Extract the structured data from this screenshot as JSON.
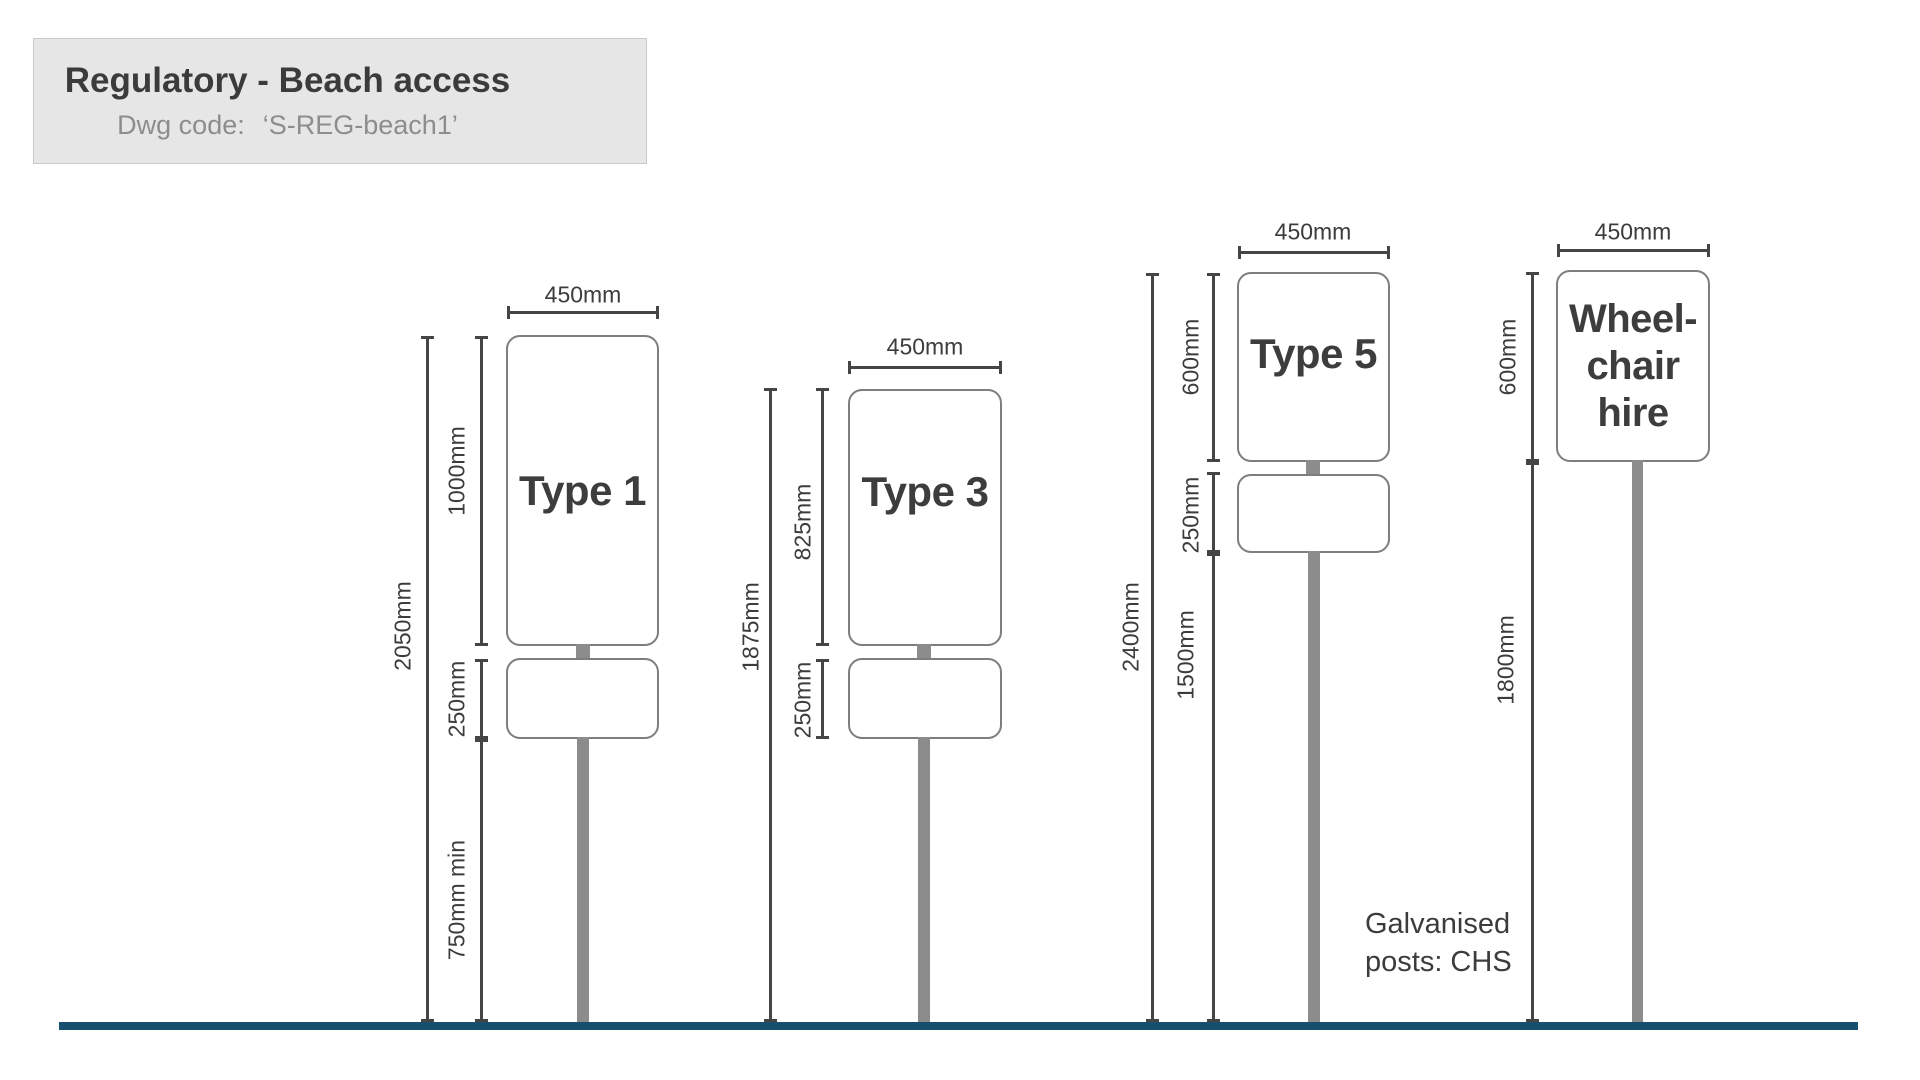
{
  "title_block": {
    "title": "Regulatory - Beach access",
    "dwg_label": "Dwg code:",
    "dwg_code": "‘S-REG-beach1’"
  },
  "note": {
    "line1": "Galvanised",
    "line2": "posts: CHS"
  },
  "colors": {
    "ground": "#15506f",
    "post": "#8c8c8c",
    "dimension_lines": "#454545",
    "sign_text": "#3d3d3d",
    "title_box_bg": "#e6e6e6"
  },
  "signs": [
    {
      "label": "Type 1",
      "width": "450mm",
      "total_height": "2050mm",
      "panel_height": "1000mm",
      "secondary_panel_height": "250mm",
      "mount_height": "750mm min"
    },
    {
      "label": "Type 3",
      "width": "450mm",
      "total_height": "1875mm",
      "panel_height": "825mm",
      "secondary_panel_height": "250mm"
    },
    {
      "label": "Type 5",
      "width": "450mm",
      "total_height": "2400mm",
      "panel_height": "600mm",
      "secondary_panel_height": "250mm",
      "mount_height": "1500mm"
    },
    {
      "label_lines": [
        "Wheel-",
        "chair",
        "hire"
      ],
      "width": "450mm",
      "panel_height": "600mm",
      "mount_height": "1800mm"
    }
  ]
}
